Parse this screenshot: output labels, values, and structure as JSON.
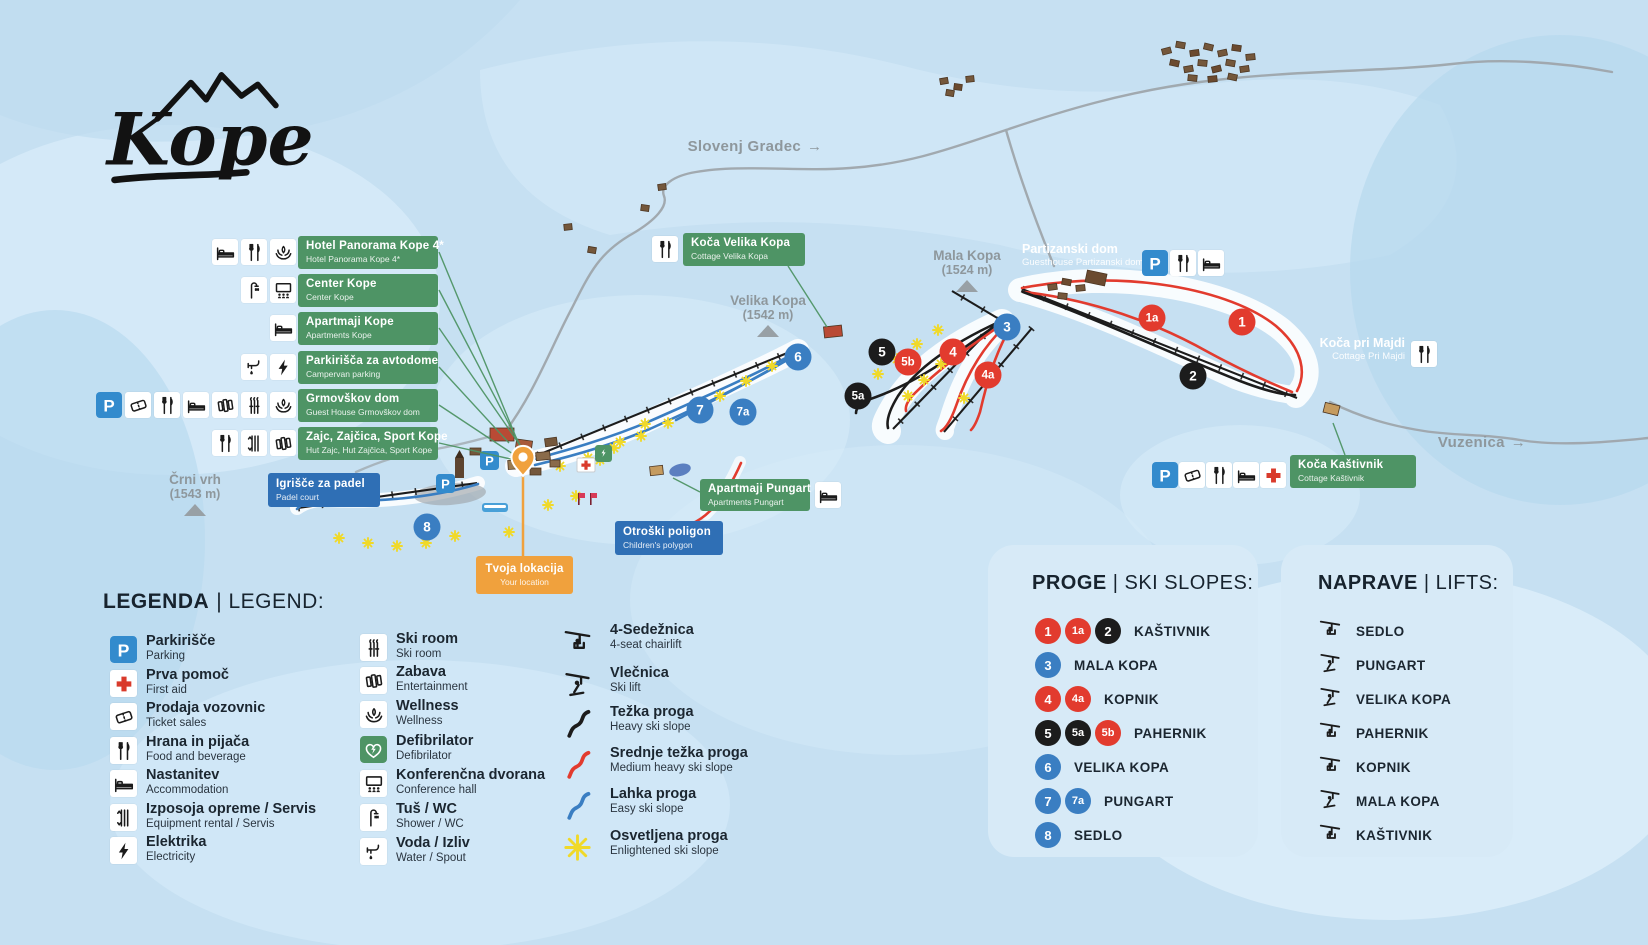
{
  "logo": {
    "text": "Kope"
  },
  "colors": {
    "bg": "#c6e0f2",
    "green": "#4e9465",
    "blue_label": "#2f6fb5",
    "orange": "#f0a13d",
    "red": "#e23b2e",
    "black": "#1c1c1c",
    "blue_circle": "#3a7ec2",
    "parking_blue": "#338bcd",
    "panel_bg": "#d7eaf7",
    "road_gray": "#9fa6ab",
    "map_text_gray": "#8e979c",
    "star_yellow": "#f0d929"
  },
  "map": {
    "direction_labels": [
      {
        "text": "Slovenj Gradec",
        "arrow": "→"
      },
      {
        "text": "Vuzenica",
        "arrow": "→"
      }
    ],
    "peaks": [
      {
        "name": "Mala Kopa",
        "elevation": "(1524 m)"
      },
      {
        "name": "Velika Kopa",
        "elevation": "(1542 m)"
      },
      {
        "name": "Črni vrh",
        "elevation": "(1543 m)"
      }
    ],
    "info_labels": [
      {
        "title": "Hotel Panorama Kope 4*",
        "subtitle": "Hotel Panorama Kope 4*",
        "icons": [
          "bed",
          "food",
          "wellness"
        ]
      },
      {
        "title": "Center Kope",
        "subtitle": "Center Kope",
        "icons": [
          "shower",
          "conference"
        ]
      },
      {
        "title": "Apartmaji Kope",
        "subtitle": "Apartments Kope",
        "icons": [
          "bed"
        ]
      },
      {
        "title": "Parkirišča za avtodome",
        "subtitle": "Campervan parking",
        "icons": [
          "water",
          "electric"
        ]
      },
      {
        "title": "Grmovškov dom",
        "subtitle": "Guest House Grmovškov dom",
        "icons": [
          "parking",
          "ticket",
          "food",
          "bed",
          "entertainment",
          "skiroom",
          "wellness"
        ]
      },
      {
        "title": "Zajc, Zajčica, Sport Kope",
        "subtitle": "Hut Zajc, Hut Zajčica, Sport Kope",
        "icons": [
          "food",
          "rental",
          "entertainment"
        ]
      }
    ],
    "site_labels": {
      "partizanski": {
        "title": "Partizanski dom",
        "subtitle": "Guesthouse Partizanski dom",
        "icons": [
          "parking",
          "food",
          "bed"
        ]
      },
      "majdi": {
        "title": "Koča pri Majdi",
        "subtitle": "Cottage Pri Majdi",
        "icons": [
          "food"
        ]
      },
      "velika_kopa_cottage": {
        "title": "Koča Velika Kopa",
        "subtitle": "Cottage Velika Kopa",
        "icons": [
          "food"
        ]
      },
      "pungart": {
        "title": "Apartmaji Pungart",
        "subtitle": "Apartments Pungart",
        "icons": [
          "bed"
        ]
      },
      "kastivnik": {
        "title": "Koča Kaštivnik",
        "subtitle": "Cottage Kaštivnik",
        "icons": [
          "parking",
          "ticket",
          "food",
          "bed",
          "firstaid"
        ]
      },
      "padel": {
        "title": "Igrišče za padel",
        "subtitle": "Padel court"
      },
      "otroski": {
        "title": "Otroški poligon",
        "subtitle": "Children's polygon"
      },
      "lokacija": {
        "title": "Tvoja lokacija",
        "subtitle": "Your location"
      }
    },
    "markers": [
      {
        "label": "1a",
        "color": "red"
      },
      {
        "label": "1",
        "color": "red"
      },
      {
        "label": "2",
        "color": "black"
      },
      {
        "label": "3",
        "color": "blue"
      },
      {
        "label": "4",
        "color": "red"
      },
      {
        "label": "4a",
        "color": "red"
      },
      {
        "label": "5",
        "color": "black"
      },
      {
        "label": "5b",
        "color": "red"
      },
      {
        "label": "5a",
        "color": "black"
      },
      {
        "label": "6",
        "color": "blue"
      },
      {
        "label": "7",
        "color": "blue"
      },
      {
        "label": "7a",
        "color": "blue"
      },
      {
        "label": "8",
        "color": "blue"
      }
    ]
  },
  "legend": {
    "title_sl": "LEGENDA",
    "title_en": "| LEGEND:",
    "columns": [
      [
        {
          "icon": "parking",
          "sl": "Parkirišče",
          "en": "Parking"
        },
        {
          "icon": "firstaid",
          "sl": "Prva pomoč",
          "en": "First aid"
        },
        {
          "icon": "ticket",
          "sl": "Prodaja vozovnic",
          "en": "Ticket sales"
        },
        {
          "icon": "food",
          "sl": "Hrana in pijača",
          "en": "Food and beverage"
        },
        {
          "icon": "bed",
          "sl": "Nastanitev",
          "en": "Accommodation"
        },
        {
          "icon": "rental",
          "sl": "Izposoja opreme / Servis",
          "en": "Equipment rental / Servis"
        },
        {
          "icon": "electric",
          "sl": "Elektrika",
          "en": "Electricity"
        }
      ],
      [
        {
          "icon": "skiroom",
          "sl": "Ski room",
          "en": "Ski room"
        },
        {
          "icon": "entertainment",
          "sl": "Zabava",
          "en": "Entertainment"
        },
        {
          "icon": "wellness",
          "sl": "Wellness",
          "en": "Wellness"
        },
        {
          "icon": "defib",
          "sl": "Defibrilator",
          "en": "Defibrilator"
        },
        {
          "icon": "conference",
          "sl": "Konferenčna dvorana",
          "en": "Conference hall"
        },
        {
          "icon": "shower",
          "sl": "Tuš / WC",
          "en": "Shower / WC"
        },
        {
          "icon": "water",
          "sl": "Voda / Izliv",
          "en": "Water / Spout"
        }
      ],
      [
        {
          "icon": "chairlift",
          "sl": "4-Sedežnica",
          "en": "4-seat chairlift"
        },
        {
          "icon": "skilift",
          "sl": "Vlečnica",
          "en": "Ski lift"
        },
        {
          "icon": "slope-black",
          "sl": "Težka proga",
          "en": "Heavy ski slope"
        },
        {
          "icon": "slope-red",
          "sl": "Srednje težka proga",
          "en": "Medium heavy ski slope"
        },
        {
          "icon": "slope-blue",
          "sl": "Lahka proga",
          "en": "Easy ski slope"
        },
        {
          "icon": "star",
          "sl": "Osvetljena proga",
          "en": "Enlightened ski slope"
        }
      ]
    ]
  },
  "slopes_panel": {
    "title_sl": "PROGE",
    "title_en": "| SKI SLOPES:",
    "rows": [
      {
        "badges": [
          {
            "label": "1",
            "color": "red"
          },
          {
            "label": "1a",
            "color": "red"
          },
          {
            "label": "2",
            "color": "black"
          }
        ],
        "name": "KAŠTIVNIK"
      },
      {
        "badges": [
          {
            "label": "3",
            "color": "blue"
          }
        ],
        "name": "MALA KOPA"
      },
      {
        "badges": [
          {
            "label": "4",
            "color": "red"
          },
          {
            "label": "4a",
            "color": "red"
          }
        ],
        "name": "KOPNIK"
      },
      {
        "badges": [
          {
            "label": "5",
            "color": "black"
          },
          {
            "label": "5a",
            "color": "black"
          },
          {
            "label": "5b",
            "color": "red"
          }
        ],
        "name": "PAHERNIK"
      },
      {
        "badges": [
          {
            "label": "6",
            "color": "blue"
          }
        ],
        "name": "VELIKA KOPA"
      },
      {
        "badges": [
          {
            "label": "7",
            "color": "blue"
          },
          {
            "label": "7a",
            "color": "blue"
          }
        ],
        "name": "PUNGART"
      },
      {
        "badges": [
          {
            "label": "8",
            "color": "blue"
          }
        ],
        "name": "SEDLO"
      }
    ]
  },
  "lifts_panel": {
    "title_sl": "NAPRAVE",
    "title_en": "| LIFTS:",
    "rows": [
      {
        "icon": "chairlift",
        "name": "SEDLO"
      },
      {
        "icon": "skilift",
        "name": "PUNGART"
      },
      {
        "icon": "skilift",
        "name": "VELIKA KOPA"
      },
      {
        "icon": "chairlift",
        "name": "PAHERNIK"
      },
      {
        "icon": "chairlift",
        "name": "KOPNIK"
      },
      {
        "icon": "skilift",
        "name": "MALA KOPA"
      },
      {
        "icon": "chairlift",
        "name": "KAŠTIVNIK"
      }
    ]
  }
}
